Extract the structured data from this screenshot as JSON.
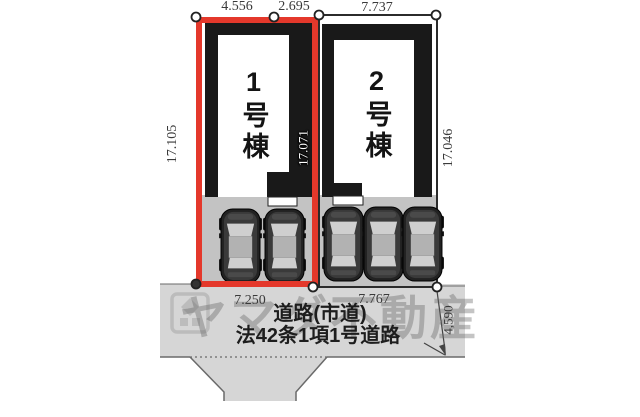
{
  "plan": {
    "title": "site-plan",
    "dimensions": {
      "top": [
        "4.556",
        "2.695",
        "7.737"
      ],
      "left": "17.105",
      "middle": "17.071",
      "right": "17.046",
      "bottom": [
        "7.250",
        "7.767"
      ],
      "road_depth": "4,590"
    },
    "buildings": [
      {
        "label": "1号棟",
        "lot_width": "7.250",
        "highlighted": true
      },
      {
        "label": "2号棟",
        "lot_width": "7.767",
        "highlighted": false
      }
    ],
    "road": {
      "line1": "道路(市道)",
      "line2": "法42条1項1号道路"
    },
    "watermark": {
      "text": "ヤマダ不動産",
      "logo": "yamada-logo"
    },
    "parking": {
      "lot1_spaces": 2,
      "lot2_spaces": 3
    },
    "colors": {
      "highlight_red": "#e4382b",
      "building_black": "#191919",
      "parking_gray": "#c3c3c3",
      "road_gray": "#d6d6d6",
      "watermark_gray": "#a8a8a8"
    }
  }
}
